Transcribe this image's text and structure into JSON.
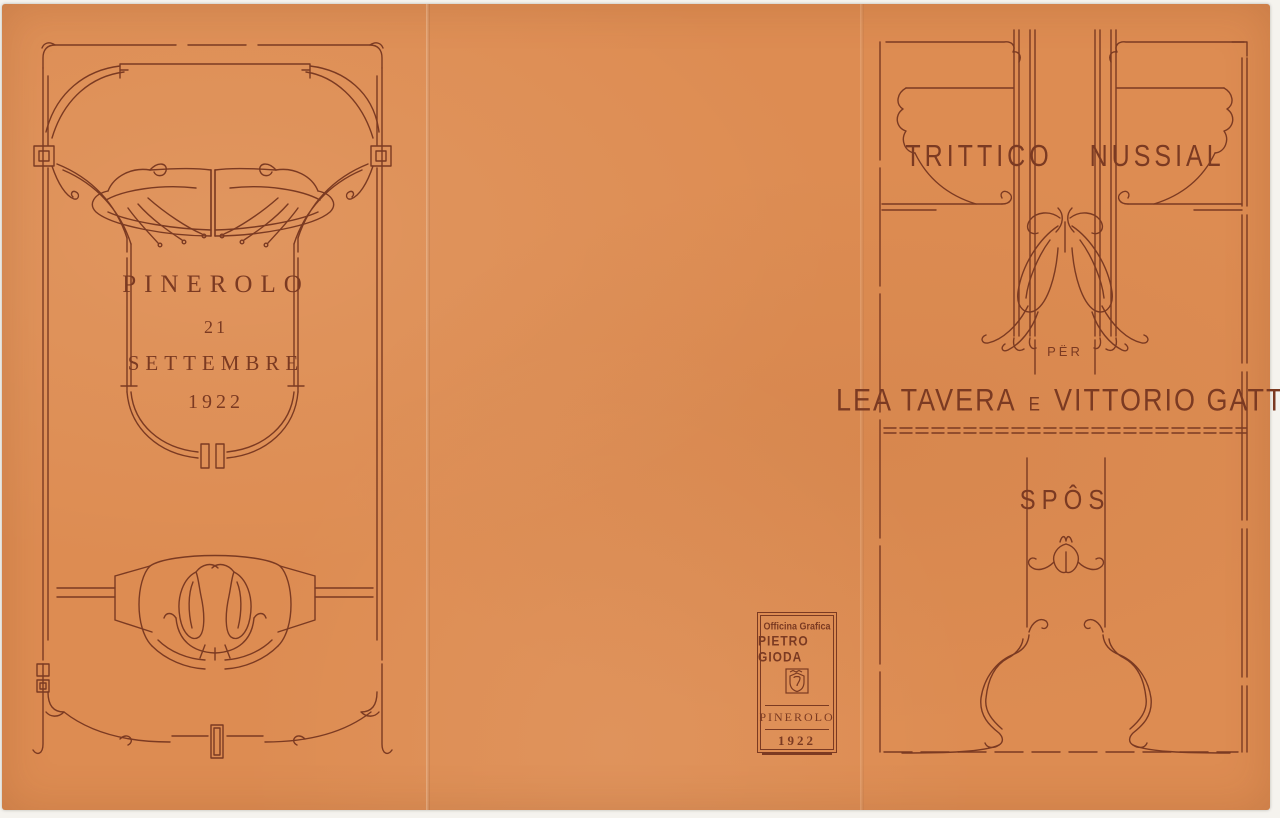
{
  "colors": {
    "paper": "#DD8C52",
    "ink": "#7B3A22",
    "scan_background": "#F5F3EE"
  },
  "left_panel": {
    "city": "PINEROLO",
    "day": "21",
    "month": "SETTEMBRE",
    "year": "1922",
    "ornaments": {
      "frame": "art-nouveau-whiplash-frame",
      "flowers": "mirrored-lily-blossoms",
      "emblem": "bud-wreath-emblem"
    }
  },
  "center_panel": {
    "printer_mark": {
      "studio": "Officina Grafica",
      "printer": "PIETRO GIODA",
      "logo": "printer-shield-monogram",
      "city": "PINEROLO",
      "year": "1922"
    }
  },
  "right_panel": {
    "title": "TRITTICO NUSSIAL",
    "preposition": "PËR",
    "bride": "LEA TAVERA",
    "conjunction": "E",
    "groom": "VITTORIO GATTI",
    "subtitle": "SPÔS",
    "ornaments": {
      "frame": "dashed-rule-frame",
      "cartouche": "title-cartouche",
      "flowers": "hanging-lily-ornament",
      "motif": "tulip-bud-motif",
      "flourish": "whiplash-bottom-flourish"
    }
  }
}
